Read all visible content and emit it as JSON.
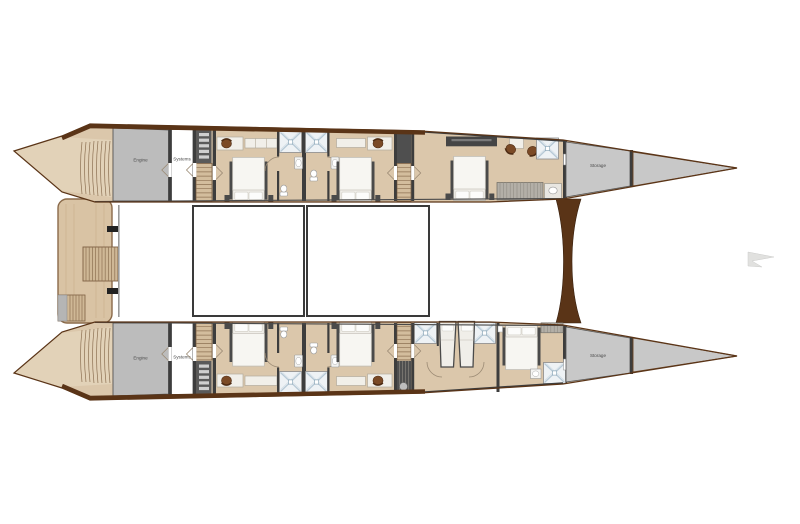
{
  "plan_labels": {
    "upper_hull": {
      "engine": "Engine",
      "systems": "Systems",
      "storage": "Storage"
    },
    "lower_hull": {
      "engine": "Engine",
      "systems": "Systems",
      "storage": "Storage"
    }
  },
  "colors": {
    "background": "#ffffff",
    "hull_trim_brown": "#5a3417",
    "floor_beige": "#dbc7ab",
    "deck_wood": "#d9c3a4",
    "stair_wood": "#cfb896",
    "engine_room_gray": "#bcbcbc",
    "bow_locker_gray": "#c8c8c8",
    "wall_dark": "#3d3d3d",
    "bed_white": "#f0eee9",
    "shower_accent": "#b7c9d6",
    "chair_brown": "#7b4a26",
    "label_text": "#4a4a4a"
  }
}
